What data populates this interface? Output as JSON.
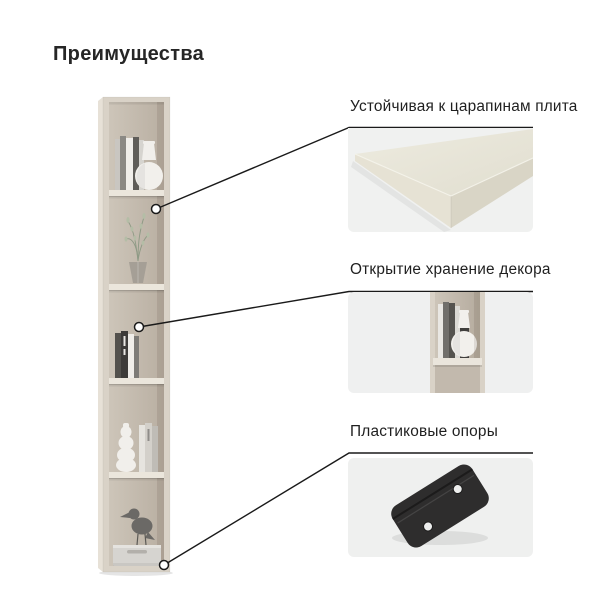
{
  "page": {
    "title": "Преимущества",
    "background": "#ffffff"
  },
  "callouts": {
    "line_color": "#1a1a1a",
    "marker_fill": "#ffffff"
  },
  "features": [
    {
      "label": "Устойчивая к царапинам плита",
      "image": "board-corner-photo"
    },
    {
      "label": "Открытие хранение декора",
      "image": "open-shelf-photo"
    },
    {
      "label": "Пластиковые опоры",
      "image": "plastic-foot-photo"
    }
  ],
  "shelf": {
    "photo": "tall-bookcase-photo"
  },
  "colors": {
    "wood": "#d9d2c7",
    "wood_interior": "#c6bdb1",
    "panel_background": "#eff0f0",
    "plastic": "#2e2d2d",
    "text": "#1f1f1f"
  }
}
